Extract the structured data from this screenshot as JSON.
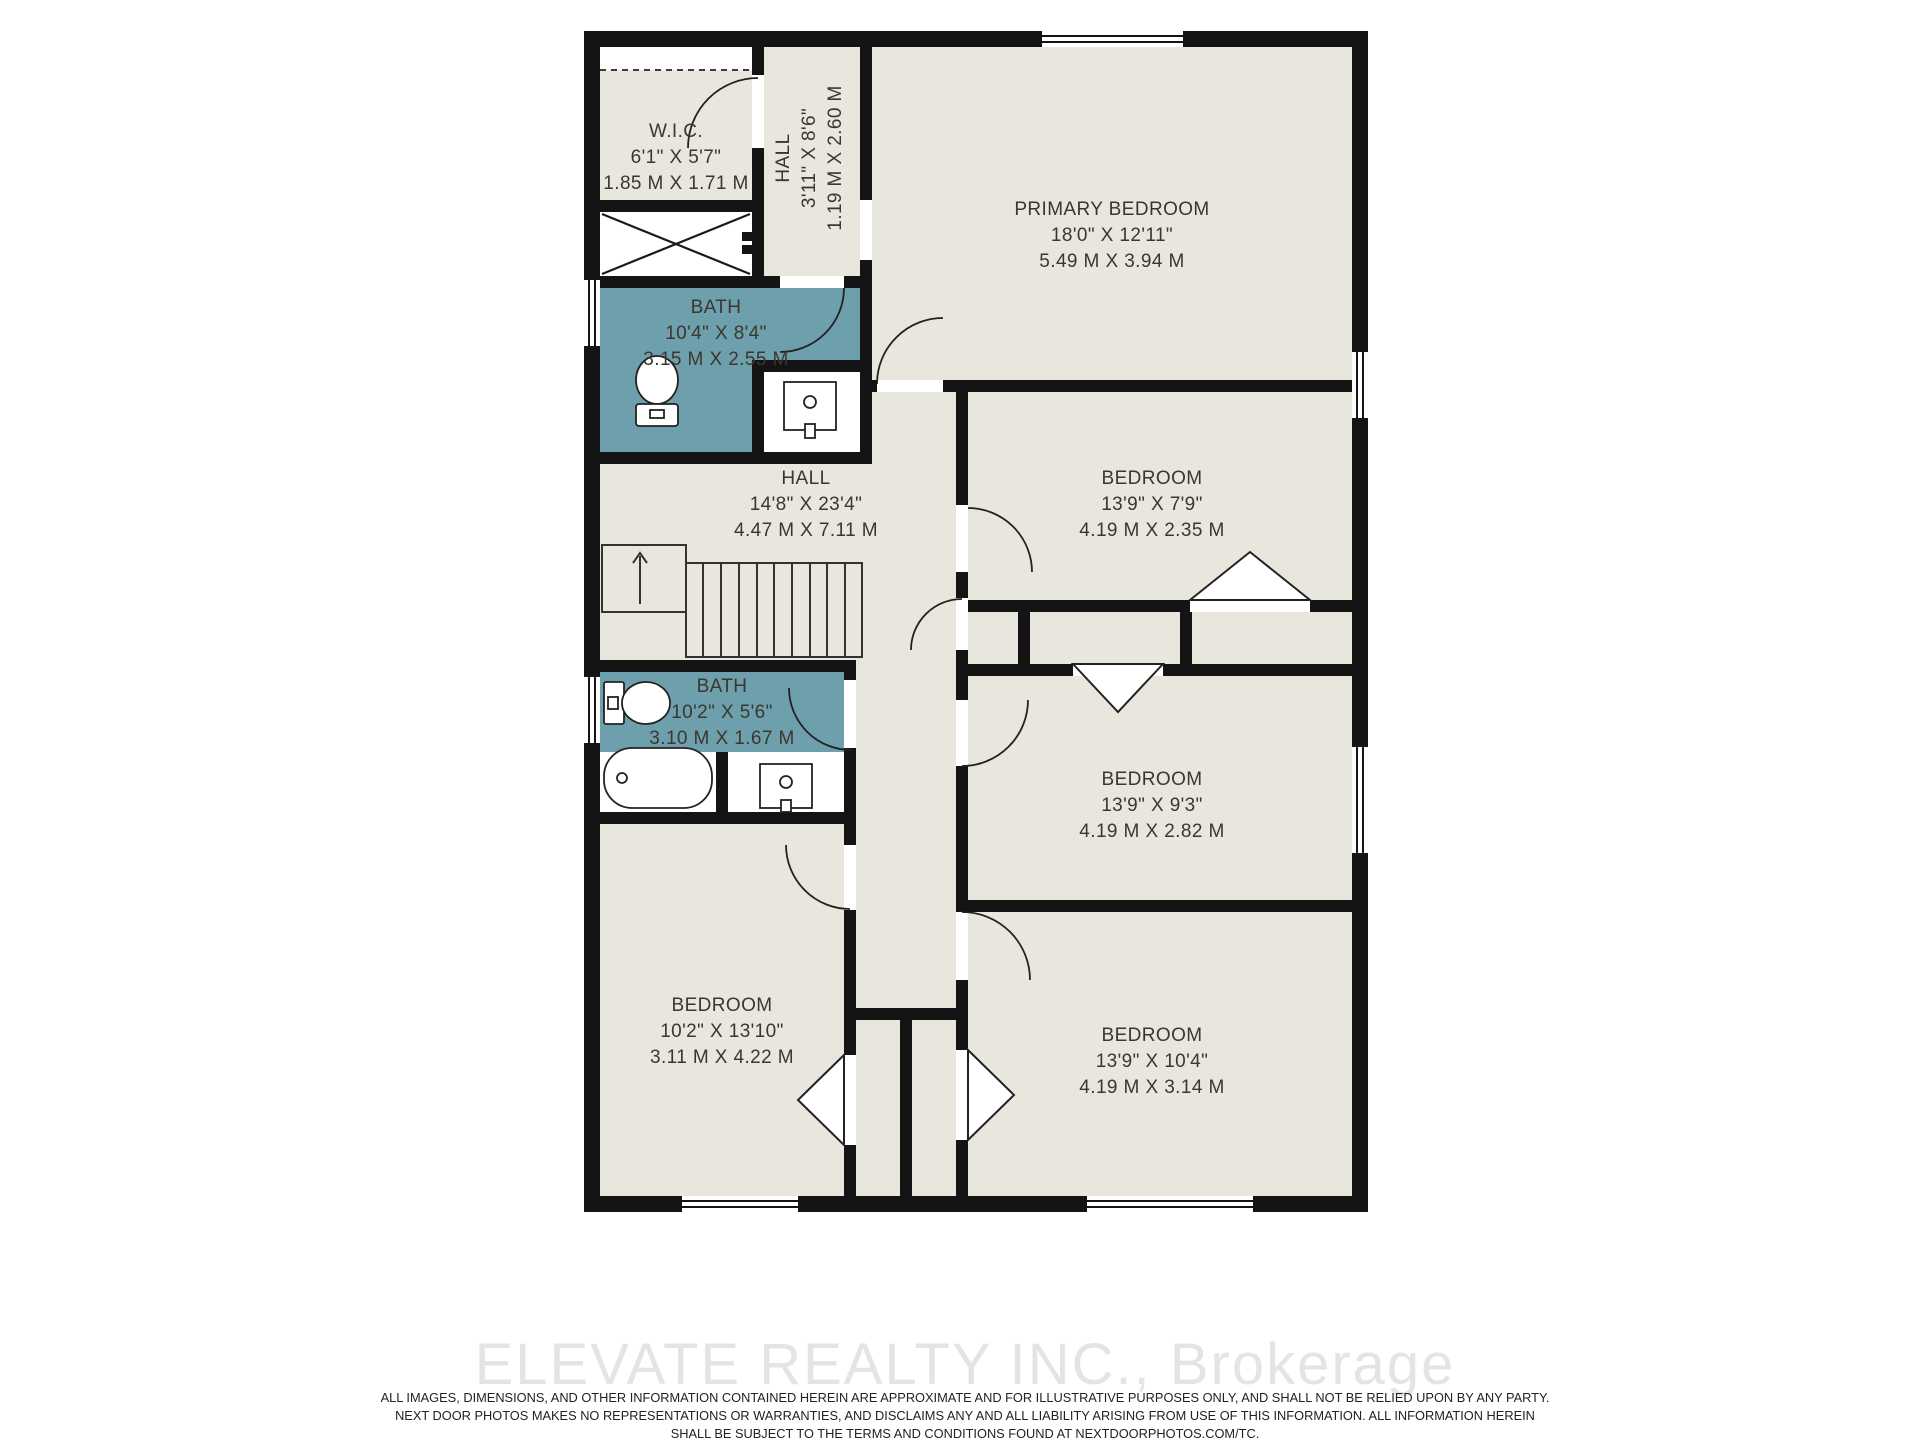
{
  "floor_plan": {
    "rooms": [
      {
        "id": "wic",
        "name": "W.I.C.",
        "dims_ft": "6'1\" X 5'7\"",
        "dims_m": "1.85 M X 1.71 M"
      },
      {
        "id": "hall-upper",
        "name": "HALL",
        "dims_ft": "3'11\" X 8'6\"",
        "dims_m": "1.19 M X 2.60 M"
      },
      {
        "id": "primary-bedroom",
        "name": "PRIMARY BEDROOM",
        "dims_ft": "18'0\" X 12'11\"",
        "dims_m": "5.49 M X 3.94 M"
      },
      {
        "id": "bath-1",
        "name": "BATH",
        "dims_ft": "10'4\" X 8'4\"",
        "dims_m": "3.15 M X 2.55 M"
      },
      {
        "id": "hall-main",
        "name": "HALL",
        "dims_ft": "14'8\" X 23'4\"",
        "dims_m": "4.47 M X 7.11 M"
      },
      {
        "id": "bedroom-2",
        "name": "BEDROOM",
        "dims_ft": "13'9\" X 7'9\"",
        "dims_m": "4.19 M X 2.35 M"
      },
      {
        "id": "bath-2",
        "name": "BATH",
        "dims_ft": "10'2\" X 5'6\"",
        "dims_m": "3.10 M X 1.67 M"
      },
      {
        "id": "bedroom-3",
        "name": "BEDROOM",
        "dims_ft": "13'9\" X 9'3\"",
        "dims_m": "4.19 M X 2.82 M"
      },
      {
        "id": "bedroom-4",
        "name": "BEDROOM",
        "dims_ft": "10'2\" X 13'10\"",
        "dims_m": "3.11 M X 4.22 M"
      },
      {
        "id": "bedroom-5",
        "name": "BEDROOM",
        "dims_ft": "13'9\" X 10'4\"",
        "dims_m": "4.19 M X 3.14 M"
      }
    ],
    "colors": {
      "room_fill": "#e9e6dd",
      "bath_fill": "#6e9fac",
      "wall": "#141414",
      "label_text": "#3b372e",
      "watermark": "#e4e4e4"
    }
  },
  "footer": {
    "watermark": "ELEVATE REALTY INC., Brokerage",
    "disclaimer_lines": [
      "ALL IMAGES, DIMENSIONS, AND OTHER INFORMATION CONTAINED HEREIN ARE APPROXIMATE AND FOR ILLUSTRATIVE PURPOSES ONLY, AND SHALL NOT BE RELIED UPON BY ANY PARTY.",
      "NEXT DOOR PHOTOS MAKES NO REPRESENTATIONS OR WARRANTIES, AND DISCLAIMS ANY AND ALL LIABILITY ARISING FROM USE OF THIS INFORMATION. ALL INFORMATION HEREIN",
      "SHALL BE SUBJECT TO THE TERMS AND CONDITIONS FOUND AT NEXTDOORPHOTOS.COM/TC."
    ]
  }
}
